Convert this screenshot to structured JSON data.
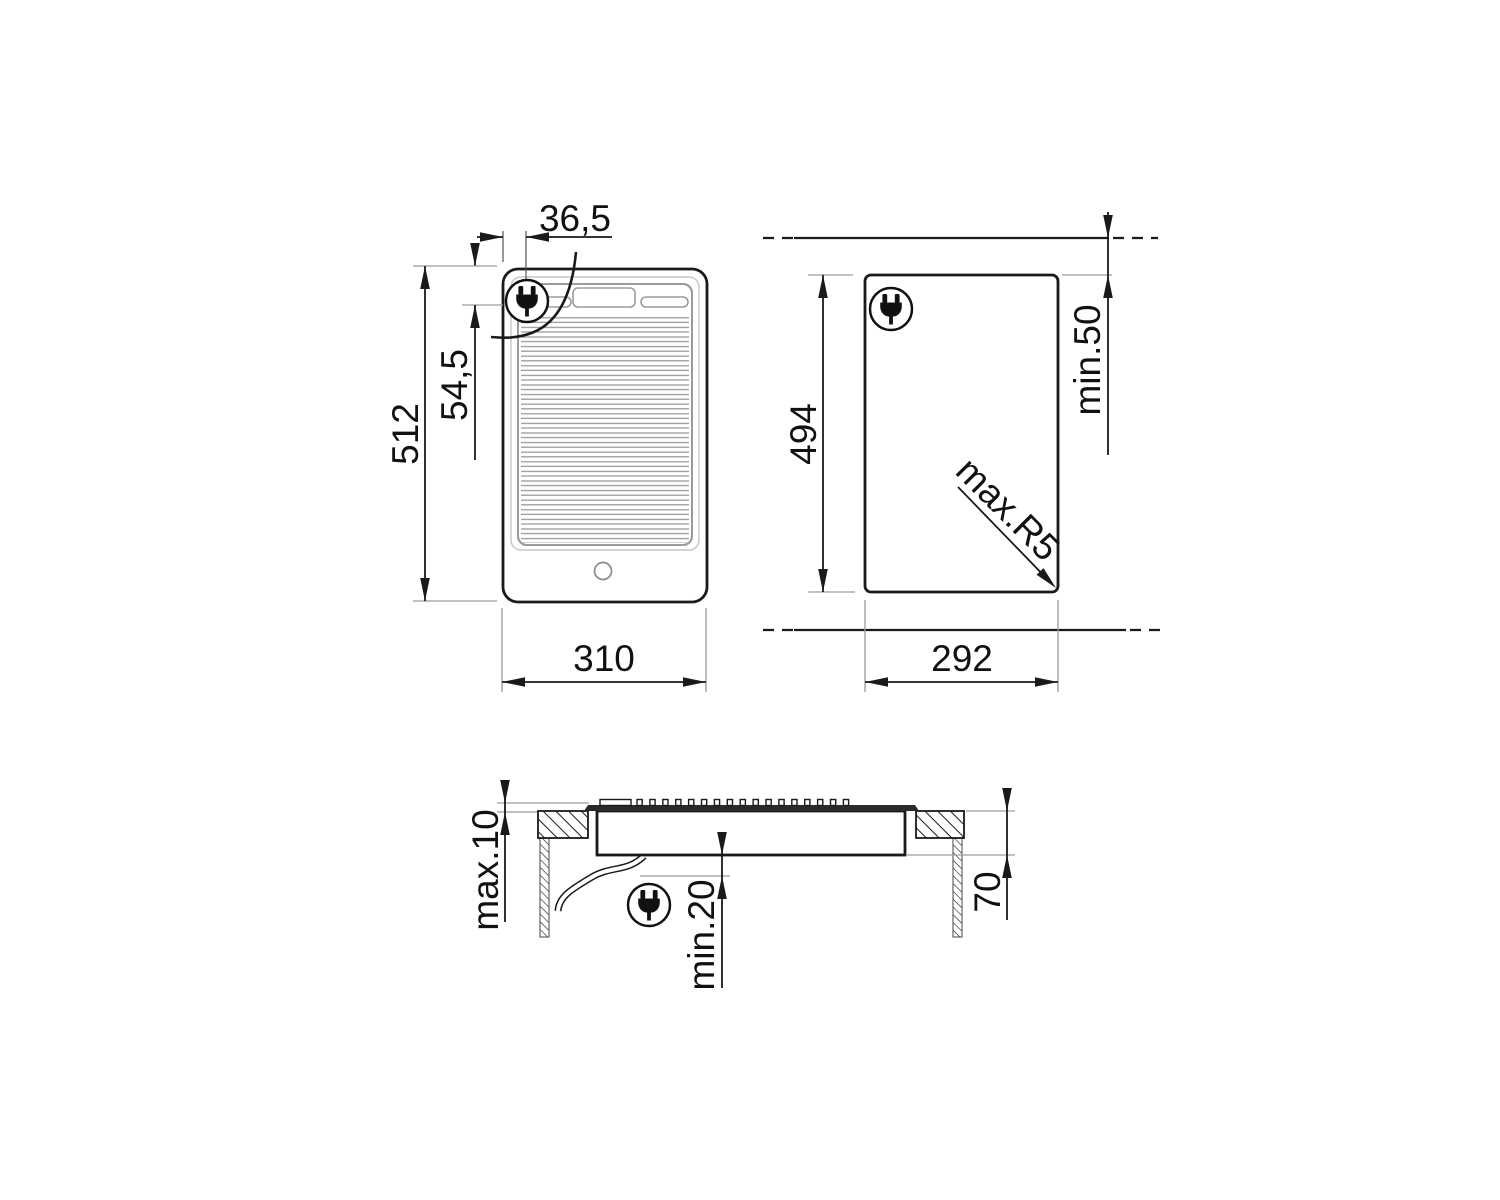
{
  "labels": {
    "plan_width": "310",
    "plan_height": "512",
    "plan_cable_x": "36,5",
    "plan_cable_y": "54,5",
    "cutout_width": "292",
    "cutout_height": "494",
    "cutout_rear_clearance": "min.50",
    "cutout_corner_radius": "max.R5",
    "section_max_above": "max.10",
    "section_min_below": "min.20",
    "section_depth": "70"
  },
  "geometry": {
    "grill_teeth_count": 17,
    "grill_teeth_start_x": 637,
    "grill_teeth_pitch": 12.9,
    "grill_teeth_y": 799.5,
    "grill_teeth_w": 5.2,
    "grill_teeth_h": 6
  },
  "icons": {
    "plug_badge": "power-plug-icon"
  },
  "colors": {
    "line": "#1a1a1a",
    "reference": "#9c9c9c",
    "panel_gray": "#9b9b9b"
  }
}
